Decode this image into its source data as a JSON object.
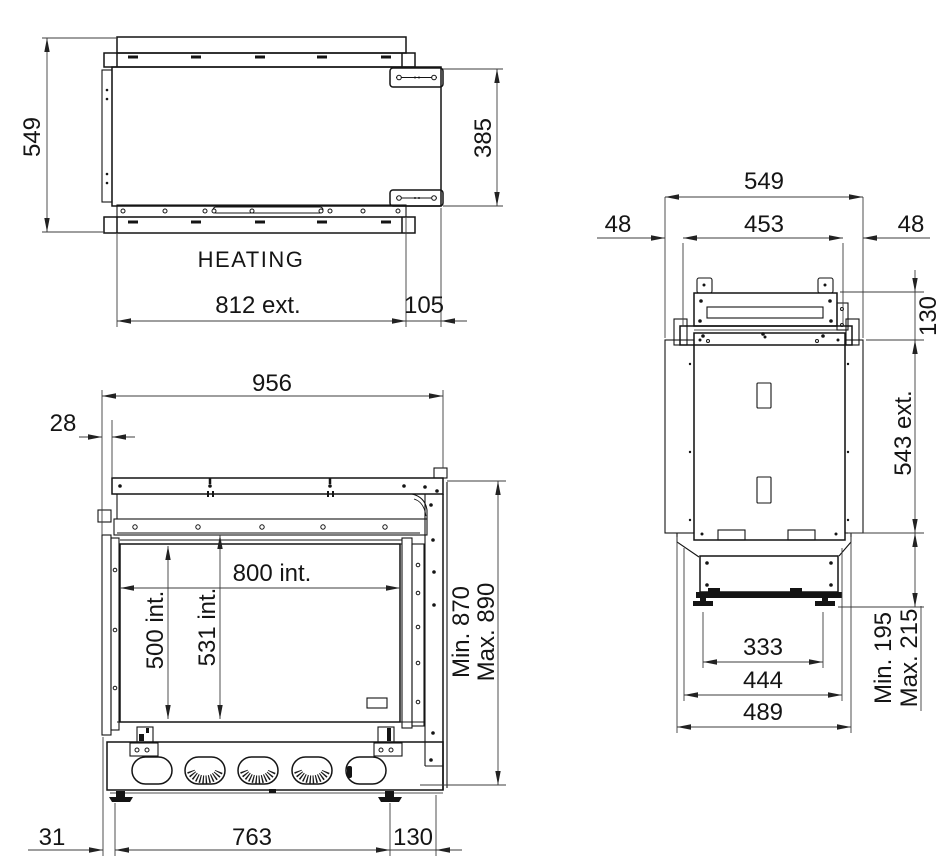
{
  "views": {
    "top": {
      "depth": "549",
      "bracket_width": "385",
      "label": "HEATING",
      "width_ext": "812 ext.",
      "right_offset": "105"
    },
    "front": {
      "overall_width": "956",
      "left_offset": "28",
      "interior_width": "800 int.",
      "glass_height": "500 int.",
      "frame_height": "531 int.",
      "height_min": "Min. 870",
      "height_max": "Max. 890",
      "foot_offset": "31",
      "feet_spacing": "763",
      "right_offset": "130"
    },
    "side": {
      "overall_depth": "549",
      "inner_depth": "453",
      "gap_front": "48",
      "gap_rear": "48",
      "top_section_height": "130",
      "ext_depth": "543 ext.",
      "feet_spacing": "333",
      "base_depth": "444",
      "base_outer_depth": "489",
      "clearance_min": "Min. 195",
      "clearance_max": "Max. 215"
    }
  }
}
